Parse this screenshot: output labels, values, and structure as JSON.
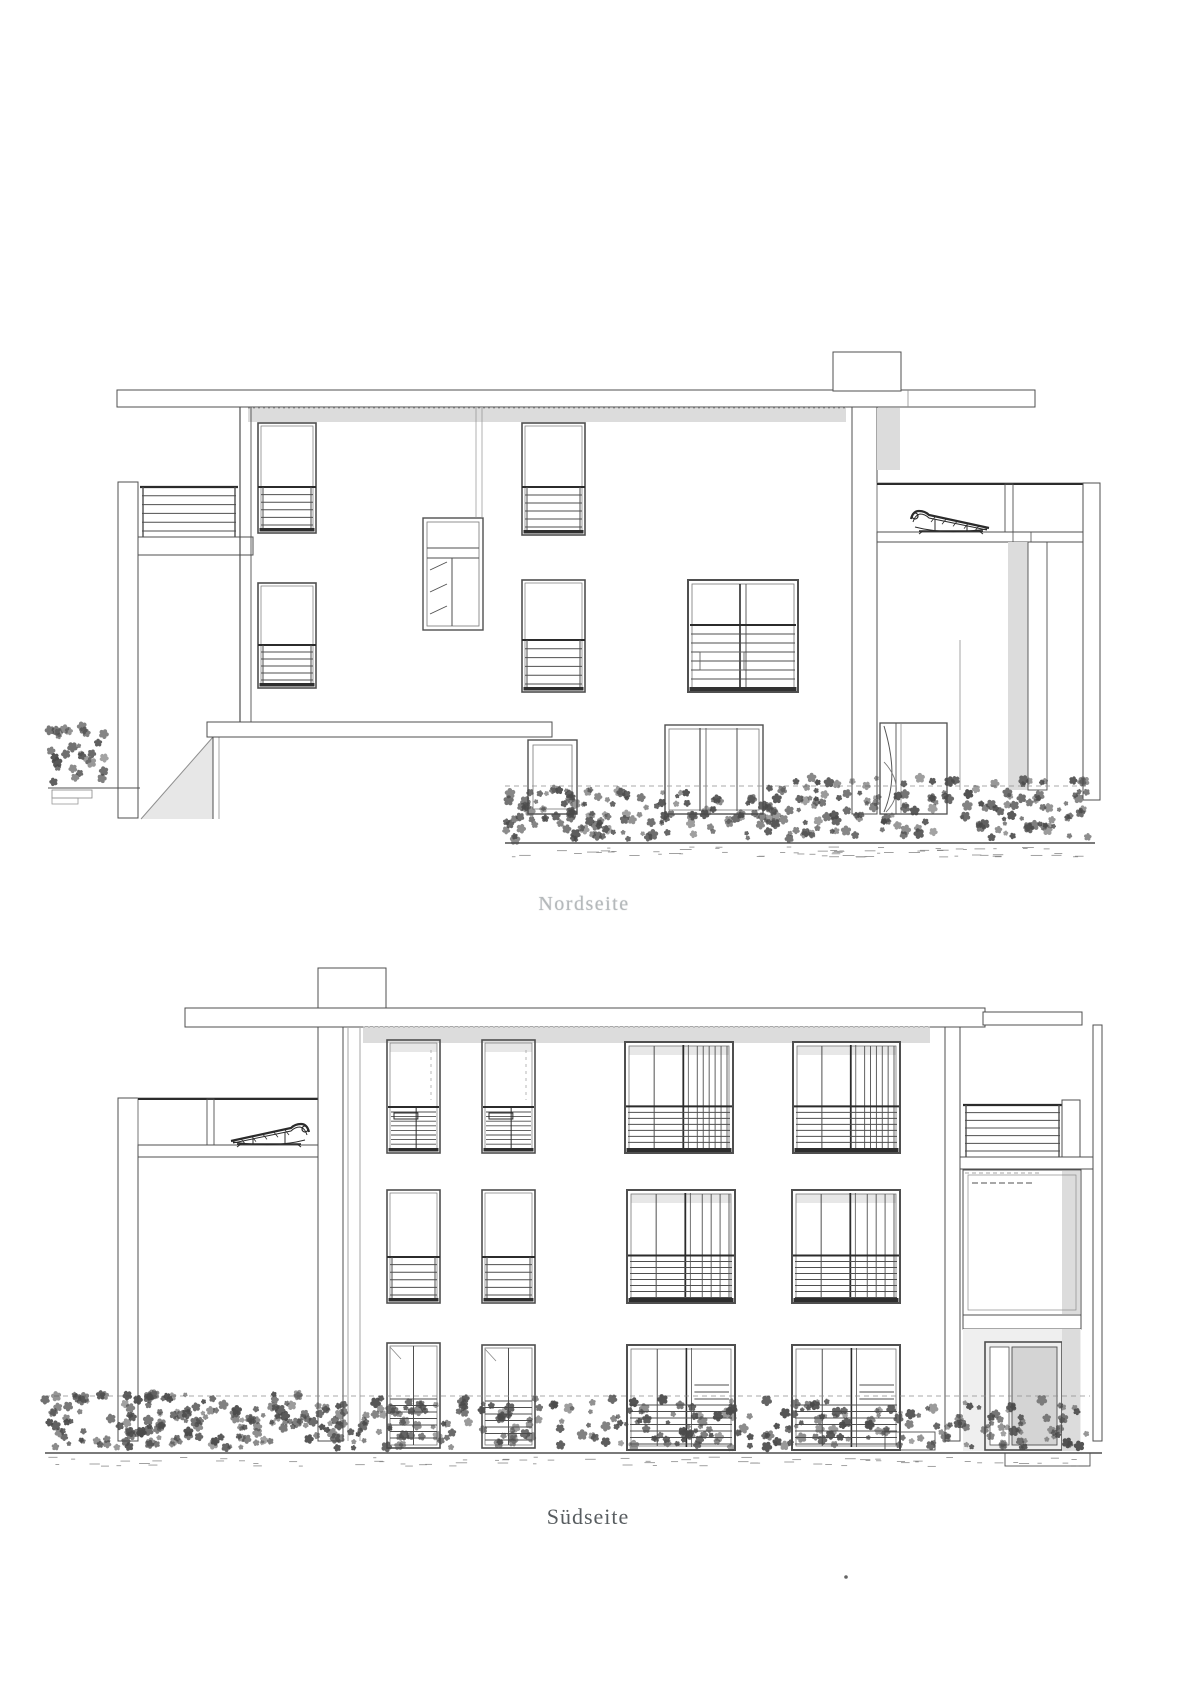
{
  "page": {
    "background_color": "#ffffff"
  },
  "figure": {
    "type": "architectural-elevation-drawing",
    "captions": {
      "top": "Nordseite",
      "bottom": "Südseite"
    },
    "caption_colors": {
      "top": "#b5b9bb",
      "bottom": "#585d60"
    },
    "palette": {
      "line": "#4f4f4f",
      "dark": "#2b2b2b",
      "light_line": "#8f8f8f",
      "shade": "#dcdcdc",
      "shade_light": "#e7e7e7",
      "flower": "#4a4a4a",
      "door_panel": "#d4d4d4",
      "sill": "#2e2e2e"
    }
  }
}
